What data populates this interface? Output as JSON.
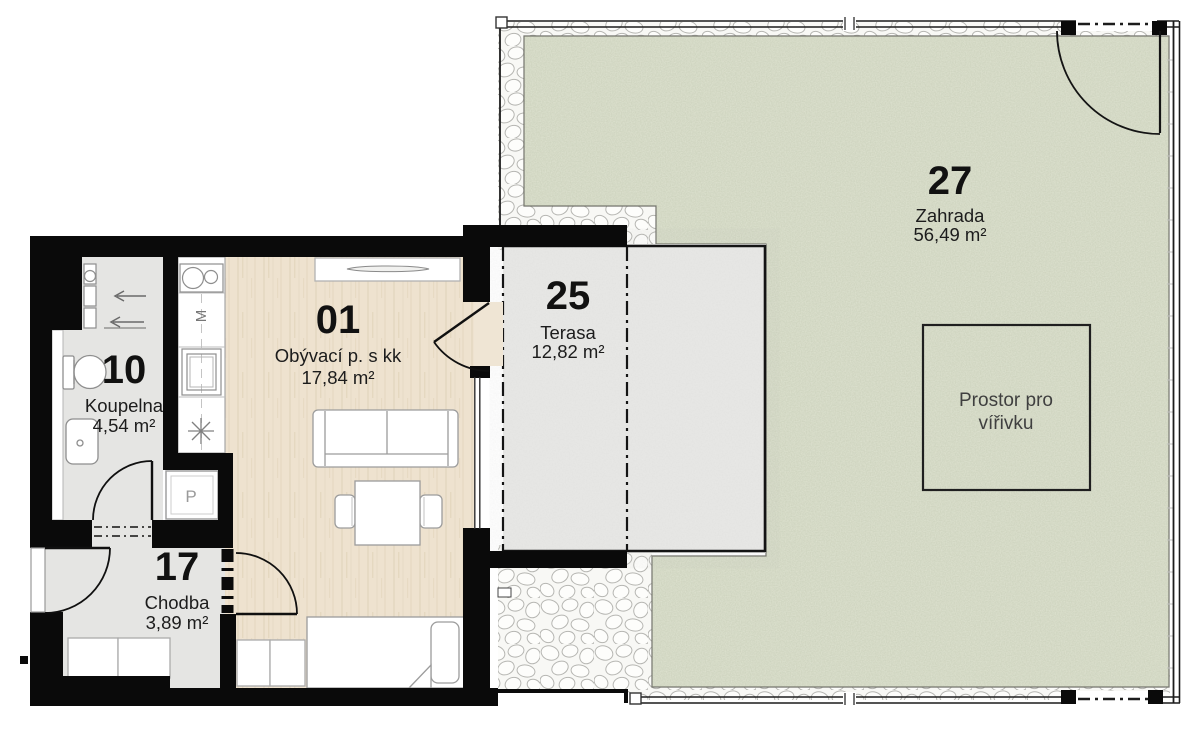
{
  "plan": {
    "title": "Apartment floor plan with terrace and garden",
    "rooms": [
      {
        "number": "01",
        "name": "Obývací p. s kk",
        "area": "17,84 m²"
      },
      {
        "number": "10",
        "name": "Koupelna",
        "area": "4,54 m²"
      },
      {
        "number": "17",
        "name": "Chodba",
        "area": "3,89 m²"
      },
      {
        "number": "25",
        "name": "Terasa",
        "area": "12,82 m²"
      },
      {
        "number": "27",
        "name": "Zahrada",
        "area": "56,49 m²"
      }
    ],
    "annotations": {
      "whirlpool_line1": "Prostor pro",
      "whirlpool_line2": "vířivku"
    },
    "appliances": {
      "dishwasher_label": "M",
      "washing_machine_label": "P"
    },
    "colors": {
      "wall": "#0a0a0a",
      "living_floor": "#eee2cf",
      "hard_floor": "#e5e5e3",
      "terrace": "#e9e9e7",
      "garden": "#dfe3d1",
      "pebble_bg": "#f8f8f5",
      "counter": "#ffffff"
    }
  }
}
